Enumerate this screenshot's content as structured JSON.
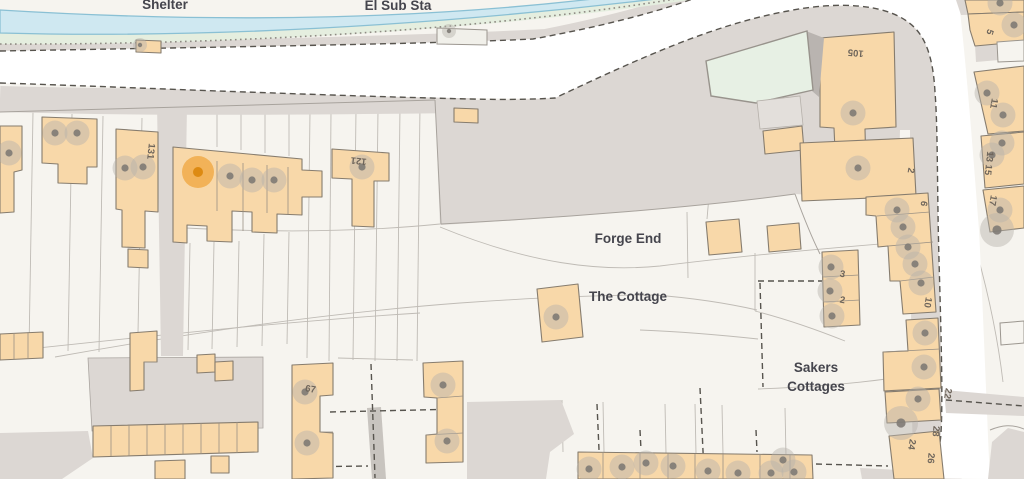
{
  "map": {
    "place_labels": {
      "shelter": "Shelter",
      "el_sub_sta": "El Sub Sta",
      "forge_end": "Forge End",
      "the_cottage": "The Cottage",
      "sakers_cottages_line1": "Sakers",
      "sakers_cottages_line2": "Cottages"
    },
    "house_numbers": [
      {
        "text": "131",
        "x": 148,
        "y": 151,
        "rotate": 96
      },
      {
        "text": "121",
        "x": 359,
        "y": 158,
        "rotate": 186
      },
      {
        "text": "105",
        "x": 856,
        "y": 50,
        "rotate": 185
      },
      {
        "text": "2",
        "x": 908,
        "y": 170,
        "rotate": 100
      },
      {
        "text": "6",
        "x": 921,
        "y": 203,
        "rotate": 102
      },
      {
        "text": "10",
        "x": 925,
        "y": 302,
        "rotate": 100
      },
      {
        "text": "3",
        "x": 842,
        "y": 277,
        "rotate": 10
      },
      {
        "text": "2",
        "x": 842,
        "y": 303,
        "rotate": 10
      },
      {
        "text": "22",
        "x": 945,
        "y": 393,
        "rotate": 100
      },
      {
        "text": "28",
        "x": 933,
        "y": 431,
        "rotate": 95
      },
      {
        "text": "24",
        "x": 909,
        "y": 444,
        "rotate": 100
      },
      {
        "text": "26",
        "x": 928,
        "y": 458,
        "rotate": 95
      },
      {
        "text": "5",
        "x": 987,
        "y": 31,
        "rotate": 108
      },
      {
        "text": "11",
        "x": 991,
        "y": 103,
        "rotate": 100
      },
      {
        "text": "13 15",
        "x": 986,
        "y": 163,
        "rotate": 96
      },
      {
        "text": "17",
        "x": 990,
        "y": 200,
        "rotate": 100
      },
      {
        "text": "67",
        "x": 310,
        "y": 392,
        "rotate": 10
      }
    ],
    "markers": {
      "selected": {
        "x": 198,
        "y": 172
      },
      "gray": [
        {
          "x": 140,
          "y": 45,
          "size": "sm"
        },
        {
          "x": 449,
          "y": 31,
          "size": "sm"
        },
        {
          "x": 9,
          "y": 153,
          "size": "md"
        },
        {
          "x": 55,
          "y": 133,
          "size": "md"
        },
        {
          "x": 77,
          "y": 133,
          "size": "md"
        },
        {
          "x": 125,
          "y": 168,
          "size": "md"
        },
        {
          "x": 143,
          "y": 167,
          "size": "md"
        },
        {
          "x": 230,
          "y": 176,
          "size": "md"
        },
        {
          "x": 252,
          "y": 180,
          "size": "md"
        },
        {
          "x": 274,
          "y": 180,
          "size": "md"
        },
        {
          "x": 362,
          "y": 167,
          "size": "md"
        },
        {
          "x": 853,
          "y": 113,
          "size": "md"
        },
        {
          "x": 858,
          "y": 168,
          "size": "md"
        },
        {
          "x": 897,
          "y": 210,
          "size": "md"
        },
        {
          "x": 903,
          "y": 227,
          "size": "md"
        },
        {
          "x": 908,
          "y": 247,
          "size": "md"
        },
        {
          "x": 915,
          "y": 264,
          "size": "md"
        },
        {
          "x": 921,
          "y": 283,
          "size": "md"
        },
        {
          "x": 925,
          "y": 333,
          "size": "md"
        },
        {
          "x": 924,
          "y": 367,
          "size": "md"
        },
        {
          "x": 918,
          "y": 399,
          "size": "md"
        },
        {
          "x": 831,
          "y": 267,
          "size": "md"
        },
        {
          "x": 830,
          "y": 291,
          "size": "md"
        },
        {
          "x": 832,
          "y": 316,
          "size": "md"
        },
        {
          "x": 556,
          "y": 317,
          "size": "md"
        },
        {
          "x": 305,
          "y": 392,
          "size": "md"
        },
        {
          "x": 307,
          "y": 443,
          "size": "md"
        },
        {
          "x": 443,
          "y": 385,
          "size": "md"
        },
        {
          "x": 447,
          "y": 441,
          "size": "md"
        },
        {
          "x": 589,
          "y": 469,
          "size": "md"
        },
        {
          "x": 622,
          "y": 467,
          "size": "md"
        },
        {
          "x": 646,
          "y": 463,
          "size": "md"
        },
        {
          "x": 673,
          "y": 466,
          "size": "md"
        },
        {
          "x": 708,
          "y": 471,
          "size": "md"
        },
        {
          "x": 738,
          "y": 473,
          "size": "md"
        },
        {
          "x": 771,
          "y": 473,
          "size": "md"
        },
        {
          "x": 783,
          "y": 460,
          "size": "md"
        },
        {
          "x": 794,
          "y": 472,
          "size": "md"
        },
        {
          "x": 987,
          "y": 93,
          "size": "md"
        },
        {
          "x": 1003,
          "y": 115,
          "size": "md"
        },
        {
          "x": 1002,
          "y": 143,
          "size": "md"
        },
        {
          "x": 992,
          "y": 155,
          "size": "md"
        },
        {
          "x": 1000,
          "y": 210,
          "size": "md"
        },
        {
          "x": 1000,
          "y": 3,
          "size": "md"
        },
        {
          "x": 1014,
          "y": 25,
          "size": "md"
        },
        {
          "x": 901,
          "y": 423,
          "size": "lg"
        },
        {
          "x": 997,
          "y": 230,
          "size": "lg"
        }
      ]
    },
    "colors": {
      "background": "#f6f4ef",
      "road_white": "#ffffff",
      "road_gray": "#dcd7d3",
      "river_fill": "#cfe8f1",
      "river_edge": "#8ac0d4",
      "riverbank_green": "#e5eedf",
      "building_fill": "#f8d8a9",
      "building_border": "#867c6e",
      "glasshouse_fill": "#e7f0e4",
      "marker_halo": "#b5b1ab",
      "marker_dot": "#7e7a74",
      "selected_halo": "#f0a943",
      "selected_dot": "#dd8a12",
      "boundary_dash": "#57544e",
      "label_text": "#45454d",
      "number_text": "#6e655b"
    }
  }
}
